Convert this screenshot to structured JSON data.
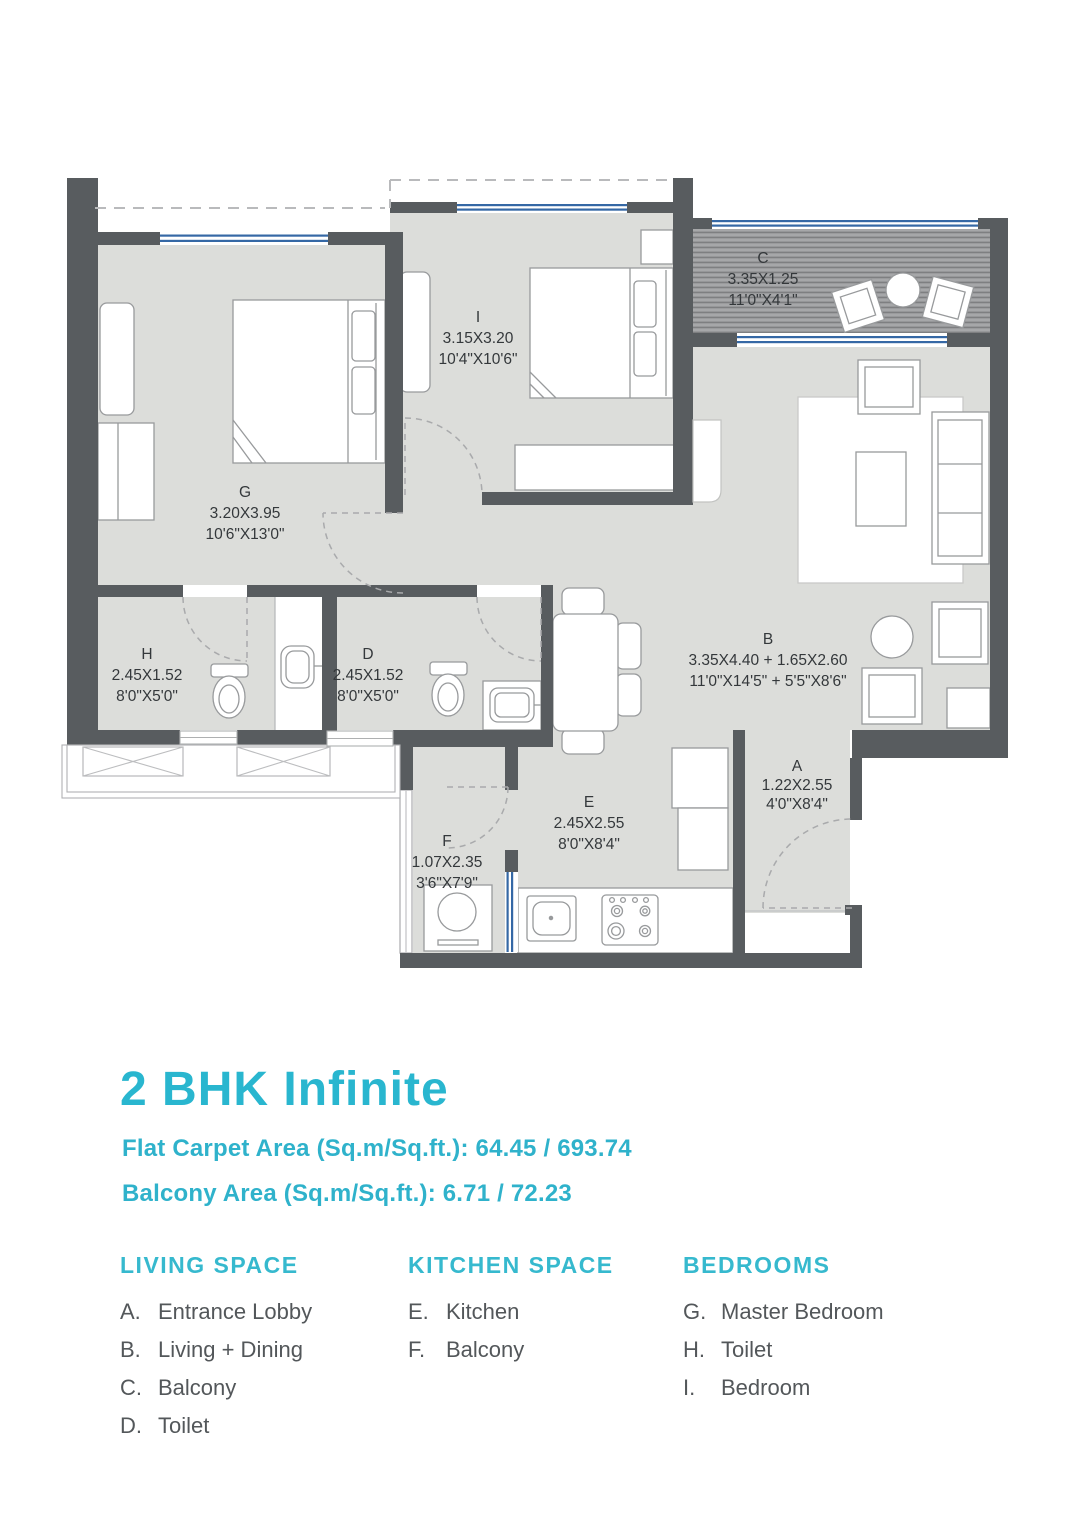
{
  "title": "2 BHK Infinite",
  "areas": {
    "carpet": "Flat Carpet Area (Sq.m/Sq.ft.): 64.45 / 693.74",
    "balcony": "Balcony Area (Sq.m/Sq.ft.): 6.71 / 72.23"
  },
  "plan": {
    "rooms": [
      {
        "letter": "G",
        "metric": "3.20X3.95",
        "imperial": "10'6\"X13'0\""
      },
      {
        "letter": "I",
        "metric": "3.15X3.20",
        "imperial": "10'4\"X10'6\""
      },
      {
        "letter": "C",
        "metric": "3.35X1.25",
        "imperial": "11'0\"X4'1\""
      },
      {
        "letter": "H",
        "metric": "2.45X1.52",
        "imperial": "8'0\"X5'0\""
      },
      {
        "letter": "D",
        "metric": "2.45X1.52",
        "imperial": "8'0\"X5'0\""
      },
      {
        "letter": "B",
        "metric": "3.35X4.40 + 1.65X2.60",
        "imperial": "11'0\"X14'5\" + 5'5\"X8'6\""
      },
      {
        "letter": "A",
        "metric": "1.22X2.55",
        "imperial": "4'0\"X8'4\""
      },
      {
        "letter": "E",
        "metric": "2.45X2.55",
        "imperial": "8'0\"X8'4\""
      },
      {
        "letter": "F",
        "metric": "1.07X2.35",
        "imperial": "3'6\"X7'9\""
      }
    ]
  },
  "legend": {
    "columns": [
      {
        "header": "LIVING SPACE",
        "items": [
          {
            "key": "A.",
            "label": "Entrance Lobby"
          },
          {
            "key": "B.",
            "label": "Living + Dining"
          },
          {
            "key": "C.",
            "label": "Balcony"
          },
          {
            "key": "D.",
            "label": "Toilet"
          }
        ]
      },
      {
        "header": "KITCHEN SPACE",
        "items": [
          {
            "key": "E.",
            "label": "Kitchen"
          },
          {
            "key": "F.",
            "label": "Balcony"
          }
        ]
      },
      {
        "header": "BEDROOMS",
        "items": [
          {
            "key": "G.",
            "label": "Master Bedroom"
          },
          {
            "key": "H.",
            "label": "Toilet"
          },
          {
            "key": "I.",
            "label": "Bedroom"
          }
        ]
      }
    ]
  },
  "colors": {
    "accent_teal": "#29b6cf",
    "wall_gray": "#585c5f",
    "floor_gray": "#dcddda",
    "window_blue": "#3568a5",
    "legend_text": "#53575a"
  }
}
